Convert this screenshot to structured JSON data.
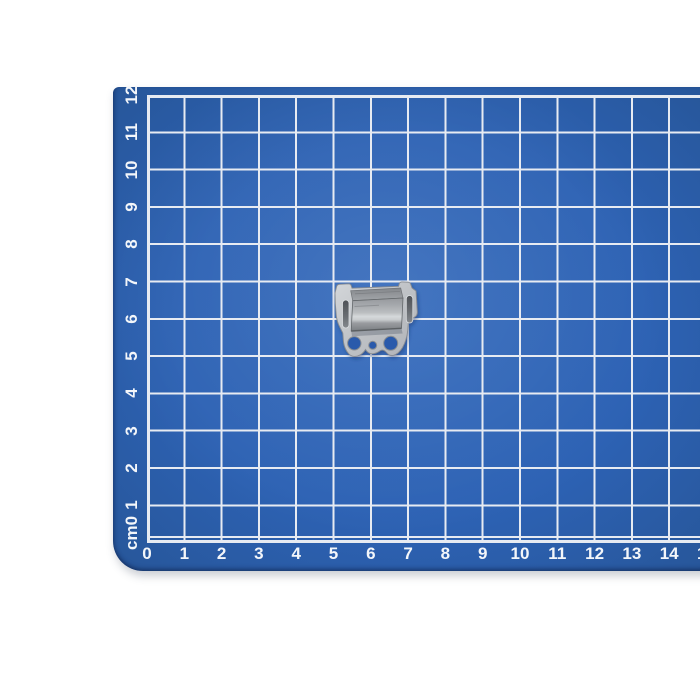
{
  "scene": {
    "description": "Small galvanized sheet-metal mounting clip lying on a blue self-healing cutting mat printed with a white centimeter grid",
    "background_color": "#ffffff"
  },
  "mat": {
    "base_color": "#2d62b4",
    "light_color": "#3067ba",
    "dark_color": "#275699",
    "grid_line_color": "#e7ebf2",
    "label_color": "#f3f6fa",
    "unit": "cm",
    "x_axis_labels": [
      "0",
      "1",
      "2",
      "3",
      "4",
      "5",
      "6",
      "7",
      "8",
      "9",
      "10",
      "11",
      "12",
      "13",
      "14",
      "15"
    ],
    "y_axis_labels": [
      "12",
      "11",
      "10",
      "9",
      "8",
      "7",
      "6",
      "5",
      "4",
      "3",
      "2",
      "1",
      "cm0"
    ]
  },
  "object": {
    "name": "galvanized metal clip",
    "metal_light": "#cdd0d4",
    "metal_mid": "#aaadb1",
    "metal_dark": "#7e8286",
    "slot_color": "#54585d",
    "hole_color": "#2b5aab"
  }
}
